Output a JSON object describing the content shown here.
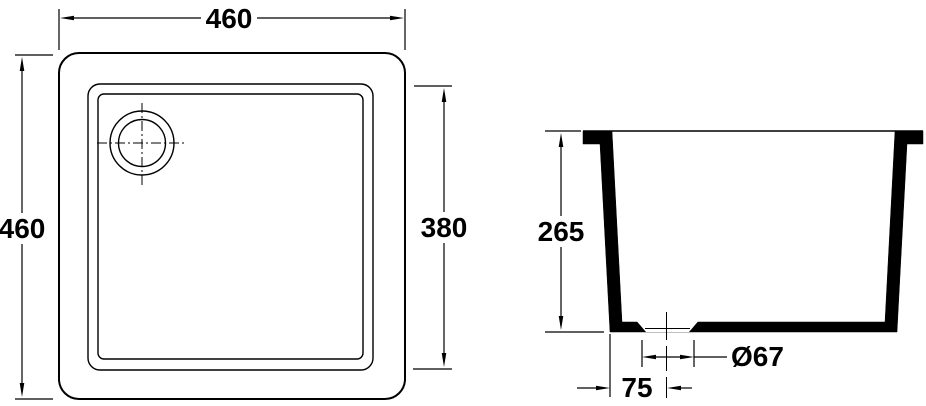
{
  "drawing": {
    "kind": "technical-dimension-drawing",
    "colors": {
      "line": "#000000",
      "background": "#ffffff"
    },
    "top_view": {
      "outer_width": "460",
      "outer_height": "460",
      "basin_width": "380"
    },
    "section_view": {
      "depth": "265",
      "drain_diameter": "Ø67",
      "drain_offset": "75"
    }
  }
}
